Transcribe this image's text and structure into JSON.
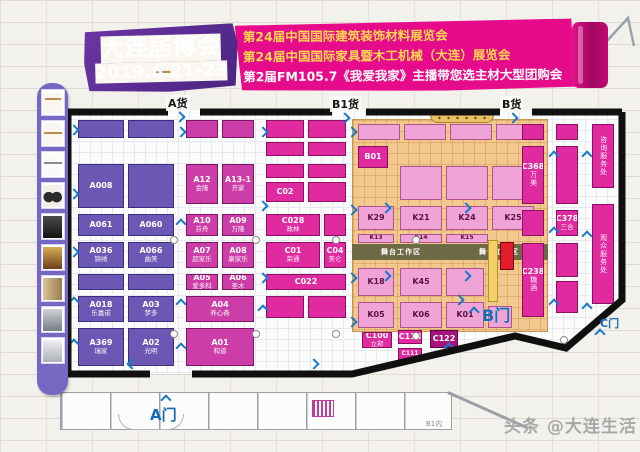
{
  "header": {
    "event_name": "大连居博会",
    "dates": "2019.6.21-23",
    "lines": [
      "第24届中国国际建筑装饰材料展览会",
      "第24届中国国际家具暨木工机械（大连）展览会",
      "第2届FM105.7《我爱我家》主播带您选主材大型团购会"
    ],
    "banner_color": "#e60b8a",
    "block_color": "#5a2b8c"
  },
  "gates": {
    "cargo_a": "A货",
    "cargo_b1": "B1货",
    "cargo_b": "B货",
    "gate_a": "A门",
    "gate_b": "B门",
    "gate_c": "C门"
  },
  "zones": {
    "stage": "舞台工作区"
  },
  "bottom": {
    "room_label": "B1内"
  },
  "watermark": "头条 @大连生活",
  "sidebar": {
    "thumbs": [
      {
        "name": "bench-sketch-thumb",
        "style": "t1"
      },
      {
        "name": "table-sketch-thumb",
        "style": "t2"
      },
      {
        "name": "desk-sketch-thumb",
        "style": "t3"
      },
      {
        "name": "chairs-photo-thumb",
        "style": "t4"
      },
      {
        "name": "sofa-photo-thumb",
        "style": "t5"
      },
      {
        "name": "interior-photo-thumb",
        "style": "t6"
      },
      {
        "name": "cabinet-photo-thumb",
        "style": "t7"
      },
      {
        "name": "machine-photo-thumb",
        "style": "t8"
      },
      {
        "name": "equipment-photo-thumb",
        "style": "t9"
      }
    ]
  },
  "floor": {
    "booths": [
      {
        "c": "pu",
        "k": "",
        "n": "",
        "x": 78,
        "y": 120,
        "w": 46,
        "h": 18
      },
      {
        "c": "pu",
        "k": "",
        "n": "",
        "x": 128,
        "y": 120,
        "w": 46,
        "h": 18
      },
      {
        "c": "pu",
        "k": "A008",
        "n": "",
        "x": 78,
        "y": 164,
        "w": 46,
        "h": 44
      },
      {
        "c": "pu",
        "k": "",
        "n": "",
        "x": 128,
        "y": 164,
        "w": 46,
        "h": 44
      },
      {
        "c": "pu",
        "k": "A061",
        "n": "",
        "x": 78,
        "y": 214,
        "w": 46,
        "h": 22
      },
      {
        "c": "pu",
        "k": "A060",
        "n": "",
        "x": 128,
        "y": 214,
        "w": 46,
        "h": 22
      },
      {
        "c": "pu",
        "k": "A036",
        "n": "锦绣",
        "x": 78,
        "y": 242,
        "w": 46,
        "h": 26
      },
      {
        "c": "pu",
        "k": "A066",
        "n": "曲美",
        "x": 128,
        "y": 242,
        "w": 46,
        "h": 26
      },
      {
        "c": "pu",
        "k": "",
        "n": "",
        "x": 78,
        "y": 274,
        "w": 46,
        "h": 16
      },
      {
        "c": "pu",
        "k": "",
        "n": "",
        "x": 128,
        "y": 274,
        "w": 46,
        "h": 16
      },
      {
        "c": "pu",
        "k": "A018",
        "n": "乐嘉诺",
        "x": 78,
        "y": 296,
        "w": 46,
        "h": 26
      },
      {
        "c": "pu",
        "k": "A03",
        "n": "梦多",
        "x": 128,
        "y": 296,
        "w": 46,
        "h": 26
      },
      {
        "c": "pu",
        "k": "A369",
        "n": "瑞家",
        "x": 78,
        "y": 328,
        "w": 46,
        "h": 38
      },
      {
        "c": "pu",
        "k": "A02",
        "n": "光明",
        "x": 128,
        "y": 328,
        "w": 46,
        "h": 38
      },
      {
        "c": "pd",
        "k": "",
        "n": "",
        "x": 186,
        "y": 120,
        "w": 32,
        "h": 18
      },
      {
        "c": "pd",
        "k": "",
        "n": "",
        "x": 222,
        "y": 120,
        "w": 32,
        "h": 18
      },
      {
        "c": "pd",
        "k": "A12",
        "n": "金隆",
        "x": 186,
        "y": 164,
        "w": 32,
        "h": 40
      },
      {
        "c": "pd",
        "k": "A13-1",
        "n": "齐家",
        "x": 222,
        "y": 164,
        "w": 32,
        "h": 40
      },
      {
        "c": "pd",
        "k": "A10",
        "n": "芬舟",
        "x": 186,
        "y": 214,
        "w": 32,
        "h": 22
      },
      {
        "c": "pd",
        "k": "A09",
        "n": "万隆",
        "x": 222,
        "y": 214,
        "w": 32,
        "h": 22
      },
      {
        "c": "pd",
        "k": "A07",
        "n": "超家乐",
        "x": 186,
        "y": 242,
        "w": 32,
        "h": 26
      },
      {
        "c": "pd",
        "k": "A08",
        "n": "康家乐",
        "x": 222,
        "y": 242,
        "w": 32,
        "h": 26
      },
      {
        "c": "pd",
        "k": "A05",
        "n": "爱多科",
        "x": 186,
        "y": 274,
        "w": 32,
        "h": 16
      },
      {
        "c": "pd",
        "k": "A06",
        "n": "圣木",
        "x": 222,
        "y": 274,
        "w": 32,
        "h": 16
      },
      {
        "c": "pd",
        "k": "A04",
        "n": "养心斋",
        "x": 186,
        "y": 296,
        "w": 68,
        "h": 26
      },
      {
        "c": "pd",
        "k": "A01",
        "n": "和道",
        "x": 186,
        "y": 328,
        "w": 68,
        "h": 38
      },
      {
        "c": "mg",
        "k": "",
        "n": "",
        "x": 266,
        "y": 120,
        "w": 38,
        "h": 18
      },
      {
        "c": "mg",
        "k": "",
        "n": "",
        "x": 308,
        "y": 120,
        "w": 38,
        "h": 18
      },
      {
        "c": "mg",
        "k": "",
        "n": "",
        "x": 266,
        "y": 142,
        "w": 38,
        "h": 14
      },
      {
        "c": "mg",
        "k": "",
        "n": "",
        "x": 308,
        "y": 142,
        "w": 38,
        "h": 14
      },
      {
        "c": "mg",
        "k": "",
        "n": "",
        "x": 266,
        "y": 164,
        "w": 38,
        "h": 14
      },
      {
        "c": "mg",
        "k": "",
        "n": "",
        "x": 308,
        "y": 164,
        "w": 38,
        "h": 14
      },
      {
        "c": "mg",
        "k": "C02",
        "n": "",
        "x": 266,
        "y": 182,
        "w": 38,
        "h": 20
      },
      {
        "c": "mg",
        "k": "",
        "n": "",
        "x": 308,
        "y": 182,
        "w": 38,
        "h": 20
      },
      {
        "c": "mg",
        "k": "C028",
        "n": "政林",
        "x": 266,
        "y": 214,
        "w": 54,
        "h": 22
      },
      {
        "c": "mg",
        "k": "",
        "n": "",
        "x": 324,
        "y": 214,
        "w": 22,
        "h": 22
      },
      {
        "c": "mg",
        "k": "C01",
        "n": "荣通",
        "x": 266,
        "y": 242,
        "w": 54,
        "h": 26
      },
      {
        "c": "mg",
        "k": "C04",
        "n": "美仑",
        "x": 324,
        "y": 242,
        "w": 22,
        "h": 26
      },
      {
        "c": "mg",
        "k": "C022",
        "n": "",
        "x": 266,
        "y": 274,
        "w": 80,
        "h": 16
      },
      {
        "c": "mg",
        "k": "",
        "n": "",
        "x": 266,
        "y": 296,
        "w": 38,
        "h": 22
      },
      {
        "c": "mg",
        "k": "",
        "n": "",
        "x": 308,
        "y": 296,
        "w": 38,
        "h": 22
      },
      {
        "c": "mg",
        "k": "C100",
        "n": "立邦",
        "x": 362,
        "y": 332,
        "w": 30,
        "h": 16
      },
      {
        "c": "mg",
        "k": "C118",
        "n": "",
        "x": 398,
        "y": 330,
        "w": 24,
        "h": 14
      },
      {
        "c": "dm",
        "k": "C122",
        "n": "",
        "x": 430,
        "y": 330,
        "w": 28,
        "h": 18
      },
      {
        "c": "mg",
        "k": "C111",
        "n": "",
        "x": 398,
        "y": 348,
        "w": 24,
        "h": 12
      },
      {
        "c": "kp",
        "k": "",
        "n": "",
        "x": 358,
        "y": 124,
        "w": 42,
        "h": 16
      },
      {
        "c": "kp",
        "k": "",
        "n": "",
        "x": 404,
        "y": 124,
        "w": 42,
        "h": 16
      },
      {
        "c": "kp",
        "k": "",
        "n": "",
        "x": 450,
        "y": 124,
        "w": 42,
        "h": 16
      },
      {
        "c": "kp",
        "k": "",
        "n": "",
        "x": 496,
        "y": 124,
        "w": 42,
        "h": 16
      },
      {
        "c": "mg",
        "k": "B01",
        "n": "",
        "x": 358,
        "y": 146,
        "w": 30,
        "h": 22
      },
      {
        "c": "kp",
        "k": "",
        "n": "",
        "x": 400,
        "y": 166,
        "w": 42,
        "h": 34
      },
      {
        "c": "kp",
        "k": "",
        "n": "",
        "x": 446,
        "y": 166,
        "w": 42,
        "h": 34
      },
      {
        "c": "kp",
        "k": "",
        "n": "",
        "x": 492,
        "y": 166,
        "w": 42,
        "h": 34
      },
      {
        "c": "kp",
        "k": "K29",
        "n": "",
        "x": 358,
        "y": 206,
        "w": 36,
        "h": 24
      },
      {
        "c": "kp",
        "k": "K21",
        "n": "",
        "x": 400,
        "y": 206,
        "w": 42,
        "h": 24
      },
      {
        "c": "kp",
        "k": "K24",
        "n": "",
        "x": 446,
        "y": 206,
        "w": 42,
        "h": 24
      },
      {
        "c": "kp",
        "k": "K25",
        "n": "",
        "x": 492,
        "y": 206,
        "w": 42,
        "h": 24
      },
      {
        "c": "kp",
        "k": "K13",
        "n": "",
        "x": 358,
        "y": 234,
        "w": 36,
        "h": 9
      },
      {
        "c": "kp",
        "k": "K14",
        "n": "",
        "x": 400,
        "y": 234,
        "w": 42,
        "h": 9
      },
      {
        "c": "kp",
        "k": "K15",
        "n": "",
        "x": 446,
        "y": 234,
        "w": 42,
        "h": 9
      },
      {
        "c": "kp",
        "k": "K18",
        "n": "",
        "x": 358,
        "y": 268,
        "w": 36,
        "h": 28
      },
      {
        "c": "kp",
        "k": "K45",
        "n": "",
        "x": 400,
        "y": 268,
        "w": 42,
        "h": 28
      },
      {
        "c": "kp",
        "k": "",
        "n": "",
        "x": 446,
        "y": 268,
        "w": 38,
        "h": 28
      },
      {
        "c": "kp",
        "k": "K05",
        "n": "",
        "x": 358,
        "y": 302,
        "w": 36,
        "h": 26
      },
      {
        "c": "kp",
        "k": "K06",
        "n": "",
        "x": 400,
        "y": 302,
        "w": 42,
        "h": 26
      },
      {
        "c": "kp",
        "k": "K01",
        "n": "",
        "x": 446,
        "y": 302,
        "w": 38,
        "h": 26
      },
      {
        "c": "kp",
        "k": "",
        "n": "",
        "x": 488,
        "y": 306,
        "w": 24,
        "h": 22
      },
      {
        "c": "yl",
        "k": "",
        "n": "",
        "x": 488,
        "y": 240,
        "w": 10,
        "h": 62
      },
      {
        "c": "rd",
        "k": "",
        "n": "",
        "x": 500,
        "y": 242,
        "w": 14,
        "h": 28
      },
      {
        "c": "mg",
        "k": "",
        "n": "",
        "x": 522,
        "y": 124,
        "w": 22,
        "h": 16
      },
      {
        "c": "mg",
        "k": "",
        "n": "",
        "x": 556,
        "y": 124,
        "w": 22,
        "h": 16
      },
      {
        "c": "mg",
        "k": "C368",
        "n": "万美",
        "x": 522,
        "y": 146,
        "w": 22,
        "h": 58,
        "v": true
      },
      {
        "c": "mg",
        "k": "",
        "n": "",
        "x": 556,
        "y": 146,
        "w": 22,
        "h": 58
      },
      {
        "c": "mg",
        "k": "",
        "n": "",
        "x": 522,
        "y": 210,
        "w": 22,
        "h": 26
      },
      {
        "c": "mg",
        "k": "C378",
        "n": "三合",
        "x": 556,
        "y": 210,
        "w": 22,
        "h": 26
      },
      {
        "c": "mg",
        "k": "C238",
        "n": "糖酒",
        "x": 522,
        "y": 243,
        "w": 22,
        "h": 74,
        "v": true
      },
      {
        "c": "mg",
        "k": "",
        "n": "",
        "x": 556,
        "y": 243,
        "w": 22,
        "h": 34
      },
      {
        "c": "mg",
        "k": "",
        "n": "",
        "x": 556,
        "y": 281,
        "w": 22,
        "h": 32
      },
      {
        "c": "mg",
        "k": "",
        "n": "咨询服务处",
        "x": 592,
        "y": 124,
        "w": 22,
        "h": 64,
        "v": true
      },
      {
        "c": "mg",
        "k": "",
        "n": "观众服务处",
        "x": 592,
        "y": 204,
        "w": 22,
        "h": 100,
        "v": true
      }
    ],
    "arrows": [
      {
        "x": 70,
        "y": 126,
        "d": "r"
      },
      {
        "x": 70,
        "y": 190,
        "d": "r"
      },
      {
        "x": 70,
        "y": 248,
        "d": "r"
      },
      {
        "x": 70,
        "y": 298,
        "d": "u"
      },
      {
        "x": 70,
        "y": 340,
        "d": "u"
      },
      {
        "x": 177,
        "y": 128,
        "d": "r"
      },
      {
        "x": 177,
        "y": 220,
        "d": "u"
      },
      {
        "x": 177,
        "y": 300,
        "d": "u"
      },
      {
        "x": 177,
        "y": 344,
        "d": "u"
      },
      {
        "x": 259,
        "y": 128,
        "d": "r"
      },
      {
        "x": 259,
        "y": 202,
        "d": "r"
      },
      {
        "x": 259,
        "y": 274,
        "d": "r"
      },
      {
        "x": 259,
        "y": 306,
        "d": "u"
      },
      {
        "x": 348,
        "y": 128,
        "d": "r"
      },
      {
        "x": 348,
        "y": 206,
        "d": "r"
      },
      {
        "x": 348,
        "y": 274,
        "d": "r"
      },
      {
        "x": 348,
        "y": 318,
        "d": "r"
      },
      {
        "x": 382,
        "y": 204,
        "d": "r"
      },
      {
        "x": 382,
        "y": 272,
        "d": "r"
      },
      {
        "x": 462,
        "y": 204,
        "d": "r"
      },
      {
        "x": 462,
        "y": 272,
        "d": "r"
      },
      {
        "x": 550,
        "y": 152,
        "d": "u"
      },
      {
        "x": 550,
        "y": 228,
        "d": "u"
      },
      {
        "x": 550,
        "y": 300,
        "d": "u"
      },
      {
        "x": 583,
        "y": 152,
        "d": "u"
      },
      {
        "x": 583,
        "y": 232,
        "d": "u"
      },
      {
        "x": 583,
        "y": 304,
        "d": "u"
      },
      {
        "x": 128,
        "y": 360,
        "d": "l"
      },
      {
        "x": 310,
        "y": 360,
        "d": "r"
      },
      {
        "x": 445,
        "y": 344,
        "d": "u"
      },
      {
        "x": 162,
        "y": 396,
        "d": "u"
      },
      {
        "x": 470,
        "y": 308,
        "d": "u"
      },
      {
        "x": 455,
        "y": 296,
        "d": "r"
      },
      {
        "x": 596,
        "y": 330,
        "d": "u"
      },
      {
        "x": 176,
        "y": 113,
        "d": "r"
      },
      {
        "x": 341,
        "y": 114,
        "d": "r"
      },
      {
        "x": 509,
        "y": 114,
        "d": "r"
      }
    ],
    "pillars": [
      {
        "x": 170,
        "y": 236
      },
      {
        "x": 252,
        "y": 236
      },
      {
        "x": 332,
        "y": 236
      },
      {
        "x": 412,
        "y": 236
      },
      {
        "x": 170,
        "y": 330
      },
      {
        "x": 252,
        "y": 330
      },
      {
        "x": 332,
        "y": 330
      },
      {
        "x": 412,
        "y": 332
      },
      {
        "x": 560,
        "y": 336
      }
    ]
  }
}
